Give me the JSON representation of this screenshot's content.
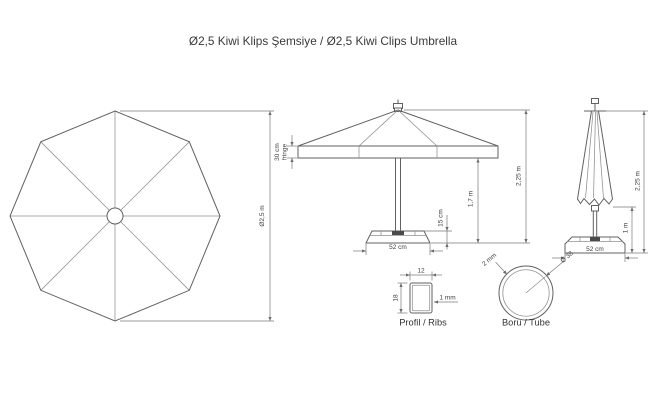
{
  "title": "Ø2,5 Kiwi Klips Şemsiye / Ø2,5 Kiwi Clips Umbrella",
  "top_view": {
    "diameter": "Ø2,5 m"
  },
  "open_view": {
    "fringe_line1": "30 cm",
    "fringe_line2": "fringe",
    "base_height": "15 cm",
    "pole_height": "1,7 m",
    "total_height": "2,25 m",
    "base_width": "52 cm"
  },
  "closed_view": {
    "total_height": "2,25 m",
    "lower_clearance": "1 m",
    "base_width": "52 cm"
  },
  "rib_detail": {
    "width": "12",
    "height": "18",
    "wall_thickness": "1 mm",
    "caption": "Profil / Ribs"
  },
  "tube_detail": {
    "wall_thickness": "2 mm",
    "diameter": "Ø 38",
    "caption": "Boru / Tube"
  },
  "colors": {
    "background": "#ffffff",
    "outline": "#616161",
    "dimension_line": "#7a7a7a",
    "text": "#3f3f3f"
  }
}
